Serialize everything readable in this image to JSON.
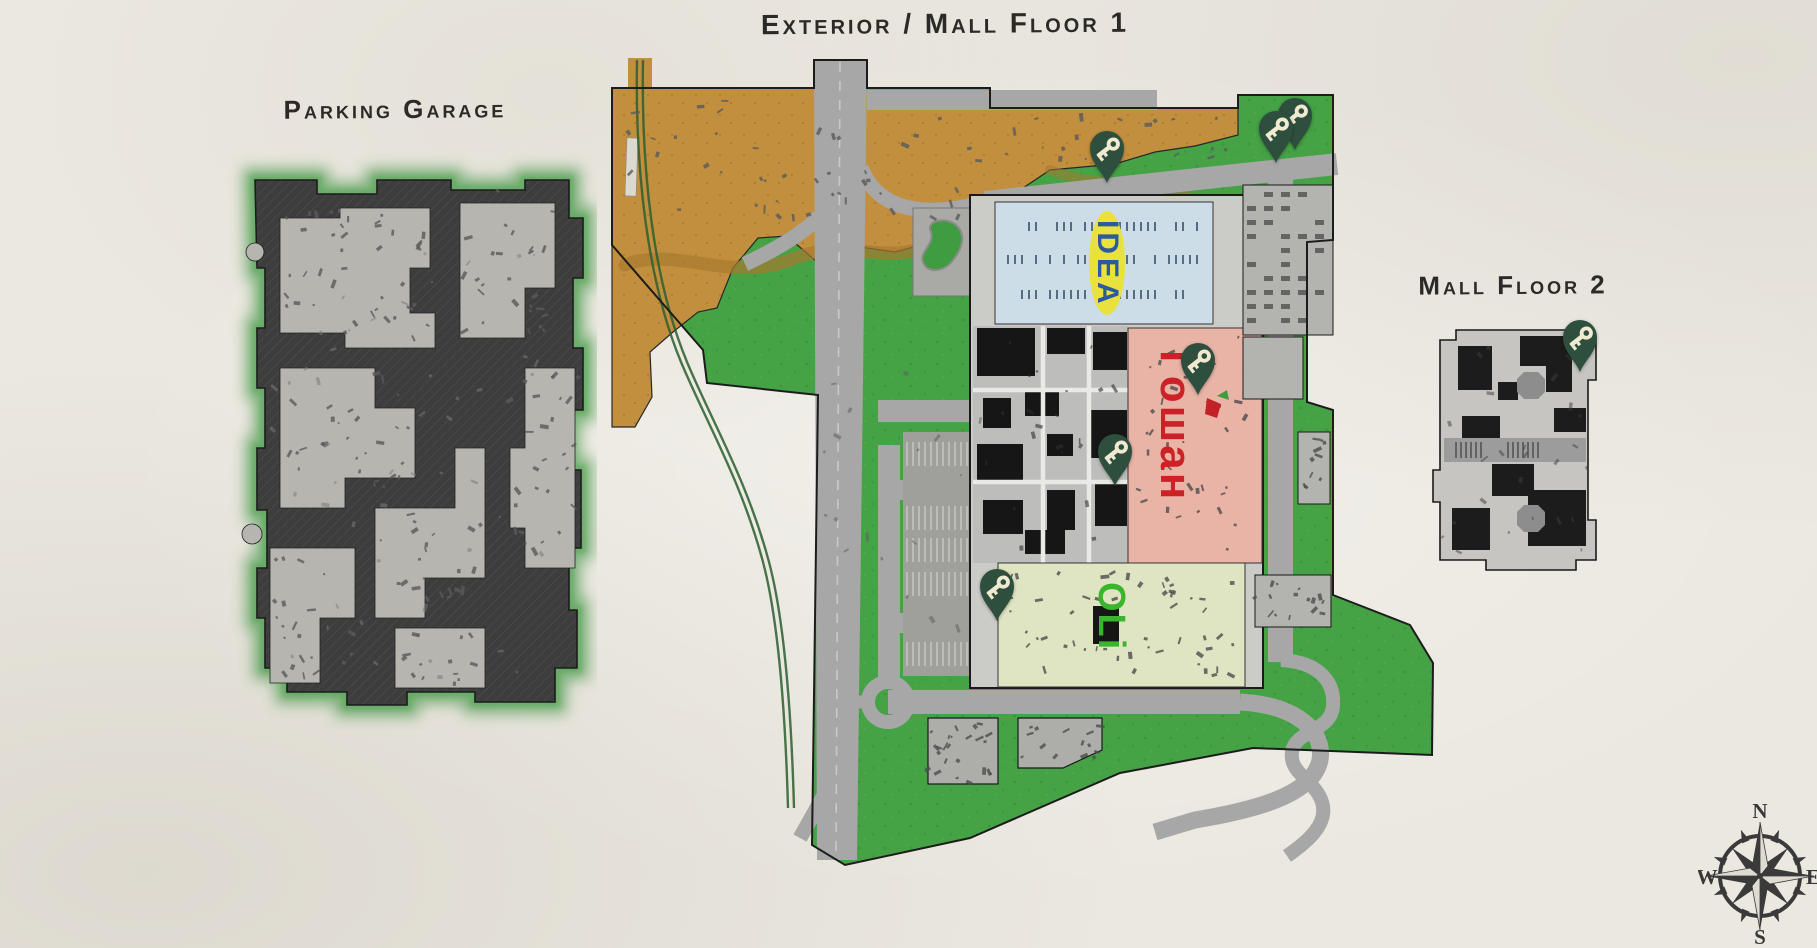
{
  "titles": {
    "main": "Exterior / Mall Floor 1",
    "parking_garage": "Parking Garage",
    "mall_floor_2": "Mall Floor 2"
  },
  "stores": {
    "idea": {
      "label": "IDEA",
      "text_color": "#2d5a9e",
      "badge_color": "#e9e23c",
      "bg": "#ccdde8"
    },
    "goshan": {
      "label": "Гошан",
      "text_color": "#cc2127",
      "bg": "#e9b4a6"
    },
    "oli": {
      "label": "OLi",
      "text_color": "#3cb52e",
      "bg": "#dfe4c2"
    }
  },
  "markers": {
    "icon": "key-icon",
    "pin_color": "#2e4f3d",
    "key_color": "#f0ead0",
    "positions": [
      {
        "map": "exterior",
        "x": 1107,
        "y": 183
      },
      {
        "map": "exterior",
        "x": 1295,
        "y": 150
      },
      {
        "map": "exterior",
        "x": 1276,
        "y": 163
      },
      {
        "map": "exterior",
        "x": 1198,
        "y": 395
      },
      {
        "map": "exterior",
        "x": 1115,
        "y": 486
      },
      {
        "map": "exterior",
        "x": 997,
        "y": 621
      },
      {
        "map": "mall-floor-2",
        "x": 1580,
        "y": 372
      }
    ]
  },
  "compass": {
    "north": "N",
    "east": "E",
    "south": "S",
    "west": "W"
  },
  "colors": {
    "paper": "#ebe8e0",
    "grass": "#45a245",
    "dirt": "#c28f3e",
    "road": "#a7a7a7",
    "garage_dark": "#3d3d3d",
    "garage_floor": "#b7b5b0",
    "building_gray": "#c6c5c1",
    "outline": "#1c1c1c"
  }
}
